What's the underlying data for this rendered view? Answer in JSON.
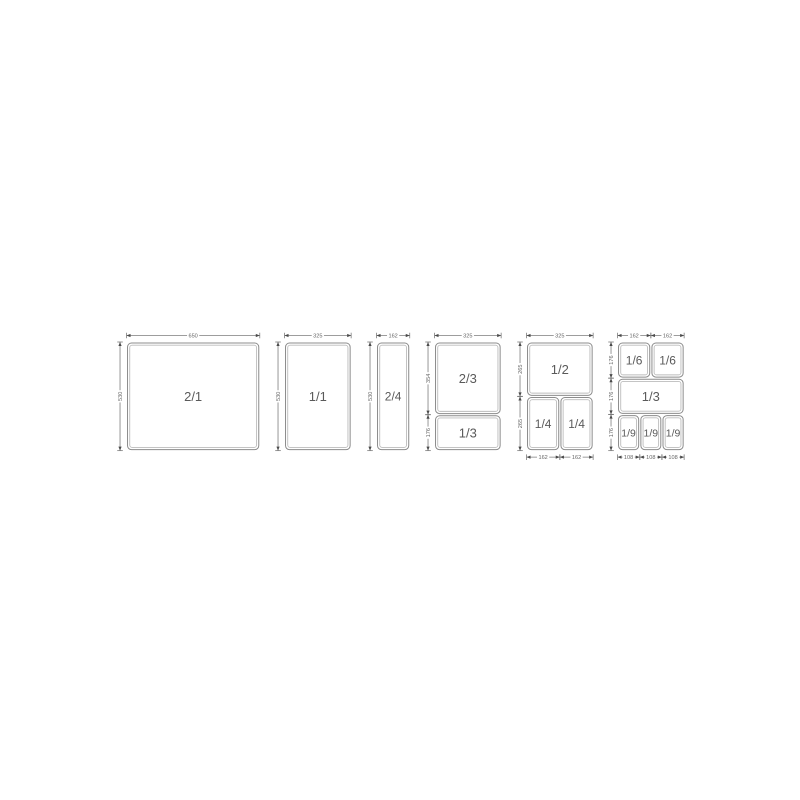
{
  "page": {
    "background": "#ffffff"
  },
  "diagram": {
    "title": "gastronorm-pan-size-chart",
    "line_color": "#8c8c8c",
    "inner_line_color": "#bcbcbc",
    "arrow_color": "#4a4a4a",
    "text_color": "#5a5a5a",
    "dim_text_color": "#666666",
    "scale_px_per_mm": 0.205,
    "groups": [
      {
        "name": "2-1",
        "box": {
          "w": 650,
          "h": 530
        },
        "pans": [
          {
            "label": "2/1",
            "x": 0,
            "y": 0,
            "w": 650,
            "h": 530
          }
        ],
        "dims": {
          "top": [
            {
              "label": "650",
              "from": 0,
              "to": 650
            }
          ],
          "left": [
            {
              "label": "530",
              "from": 0,
              "to": 530
            }
          ],
          "bottom": []
        }
      },
      {
        "name": "1-1",
        "box": {
          "w": 325,
          "h": 530
        },
        "pans": [
          {
            "label": "1/1",
            "x": 0,
            "y": 0,
            "w": 325,
            "h": 530
          }
        ],
        "dims": {
          "top": [
            {
              "label": "325",
              "from": 0,
              "to": 325
            }
          ],
          "left": [
            {
              "label": "530",
              "from": 0,
              "to": 530
            }
          ],
          "bottom": []
        }
      },
      {
        "name": "2-4",
        "box": {
          "w": 162,
          "h": 530
        },
        "pans": [
          {
            "label": "2/4",
            "x": 0,
            "y": 0,
            "w": 162,
            "h": 530
          }
        ],
        "dims": {
          "top": [
            {
              "label": "162",
              "from": 0,
              "to": 162
            }
          ],
          "left": [
            {
              "label": "530",
              "from": 0,
              "to": 530
            }
          ],
          "bottom": []
        }
      },
      {
        "name": "2-3_1-3",
        "box": {
          "w": 325,
          "h": 530
        },
        "pans": [
          {
            "label": "2/3",
            "x": 0,
            "y": 0,
            "w": 325,
            "h": 354
          },
          {
            "label": "1/3",
            "x": 0,
            "y": 355,
            "w": 325,
            "h": 175
          }
        ],
        "dims": {
          "top": [
            {
              "label": "325",
              "from": 0,
              "to": 325
            }
          ],
          "left": [
            {
              "label": "354",
              "from": 0,
              "to": 354
            },
            {
              "label": "176",
              "from": 355,
              "to": 530
            }
          ],
          "bottom": []
        }
      },
      {
        "name": "1-2_1-4",
        "box": {
          "w": 325,
          "h": 530
        },
        "pans": [
          {
            "label": "1/2",
            "x": 0,
            "y": 0,
            "w": 325,
            "h": 265
          },
          {
            "label": "1/4",
            "x": 0,
            "y": 266,
            "w": 162,
            "h": 264
          },
          {
            "label": "1/4",
            "x": 163,
            "y": 266,
            "w": 162,
            "h": 264
          }
        ],
        "dims": {
          "top": [
            {
              "label": "325",
              "from": 0,
              "to": 325
            }
          ],
          "left": [
            {
              "label": "265",
              "from": 0,
              "to": 265
            },
            {
              "label": "265",
              "from": 266,
              "to": 530
            }
          ],
          "bottom": [
            {
              "label": "162",
              "from": 0,
              "to": 162
            },
            {
              "label": "162",
              "from": 163,
              "to": 325
            }
          ]
        }
      },
      {
        "name": "1-6_1-3_1-9",
        "box": {
          "w": 325,
          "h": 530
        },
        "pans": [
          {
            "label": "1/6",
            "x": 0,
            "y": 0,
            "w": 162,
            "h": 176
          },
          {
            "label": "1/6",
            "x": 163,
            "y": 0,
            "w": 162,
            "h": 176
          },
          {
            "label": "1/3",
            "x": 0,
            "y": 177,
            "w": 325,
            "h": 176
          },
          {
            "label": "1/9",
            "x": 0,
            "y": 354,
            "w": 108,
            "h": 176
          },
          {
            "label": "1/9",
            "x": 109,
            "y": 354,
            "w": 107,
            "h": 176
          },
          {
            "label": "1/9",
            "x": 217,
            "y": 354,
            "w": 108,
            "h": 176
          }
        ],
        "dims": {
          "top": [
            {
              "label": "162",
              "from": 0,
              "to": 162
            },
            {
              "label": "162",
              "from": 163,
              "to": 325
            }
          ],
          "left": [
            {
              "label": "176",
              "from": 0,
              "to": 176
            },
            {
              "label": "176",
              "from": 177,
              "to": 353
            },
            {
              "label": "176",
              "from": 354,
              "to": 530
            }
          ],
          "bottom": [
            {
              "label": "108",
              "from": 0,
              "to": 108
            },
            {
              "label": "108",
              "from": 109,
              "to": 216
            },
            {
              "label": "108",
              "from": 217,
              "to": 325
            }
          ]
        }
      }
    ]
  }
}
